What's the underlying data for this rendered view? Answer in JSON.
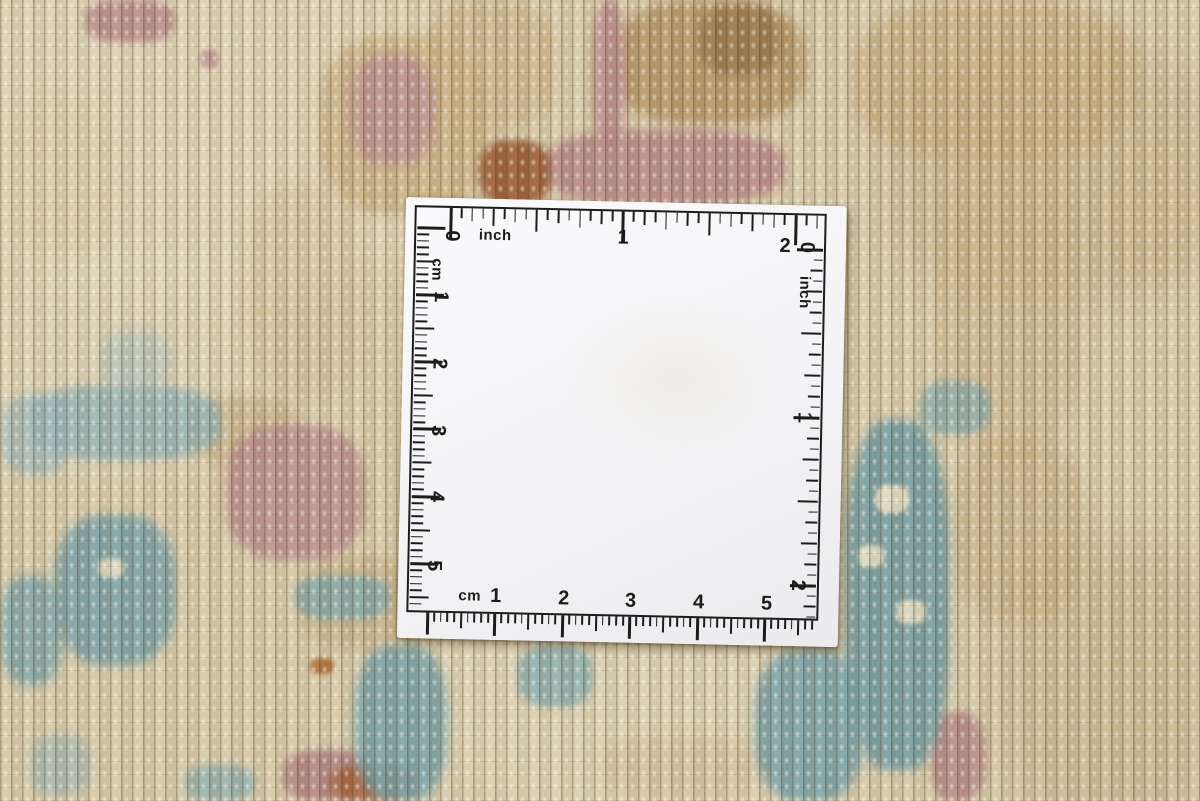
{
  "ruler_card": {
    "card_color": "#f5f5f7",
    "ink_color": "#1c1c1c",
    "top_scale": {
      "unit": "inch",
      "labels": [
        "0",
        "1",
        "2"
      ]
    },
    "right_scale": {
      "unit": "inch",
      "labels": [
        "0",
        "1",
        "2"
      ]
    },
    "left_scale": {
      "unit": "cm",
      "labels": [
        "1",
        "2",
        "3",
        "4",
        "5"
      ]
    },
    "bottom_scale": {
      "unit": "cm",
      "labels": [
        "1",
        "2",
        "3",
        "4",
        "5"
      ]
    }
  },
  "rug": {
    "base_color": "#d6c9a8",
    "accent_colors": {
      "cream": "#e3d9bc",
      "tan": "#c0a274",
      "brown": "#97754a",
      "rose": "#b88888",
      "russet": "#9a5a33",
      "teal": "#74a0a6",
      "light_blue": "#8fb0b4"
    }
  }
}
